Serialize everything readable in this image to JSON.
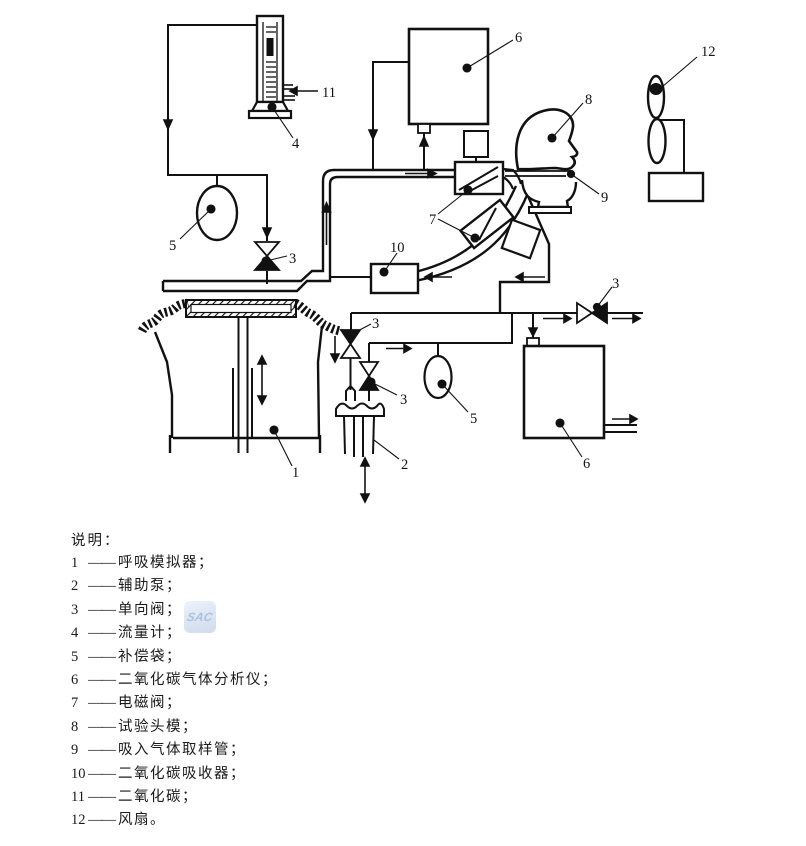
{
  "document": {
    "legend": {
      "title": "说明：",
      "dash": "——",
      "items": [
        {
          "num": "1",
          "label": "呼吸模拟器；"
        },
        {
          "num": "2",
          "label": "辅助泵；"
        },
        {
          "num": "3",
          "label": "单向阀；"
        },
        {
          "num": "4",
          "label": "流量计；"
        },
        {
          "num": "5",
          "label": "补偿袋；"
        },
        {
          "num": "6",
          "label": "二氧化碳气体分析仪；"
        },
        {
          "num": "7",
          "label": "电磁阀；"
        },
        {
          "num": "8",
          "label": "试验头模；"
        },
        {
          "num": "9",
          "label": "吸入气体取样管；"
        },
        {
          "num": "10",
          "label": "二氧化碳吸收器；"
        },
        {
          "num": "11",
          "label": "二氧化碳；"
        },
        {
          "num": "12",
          "label": "风扇。"
        }
      ]
    },
    "watermark": {
      "text": "SAC"
    },
    "diagram": {
      "ink_color": "#111111",
      "labels": {
        "l1": "1",
        "l2": "2",
        "l3": "3",
        "l4": "4",
        "l5": "5",
        "l6": "6",
        "l7": "7",
        "l8": "8",
        "l9": "9",
        "l10": "10",
        "l11": "11",
        "l12": "12"
      }
    }
  }
}
